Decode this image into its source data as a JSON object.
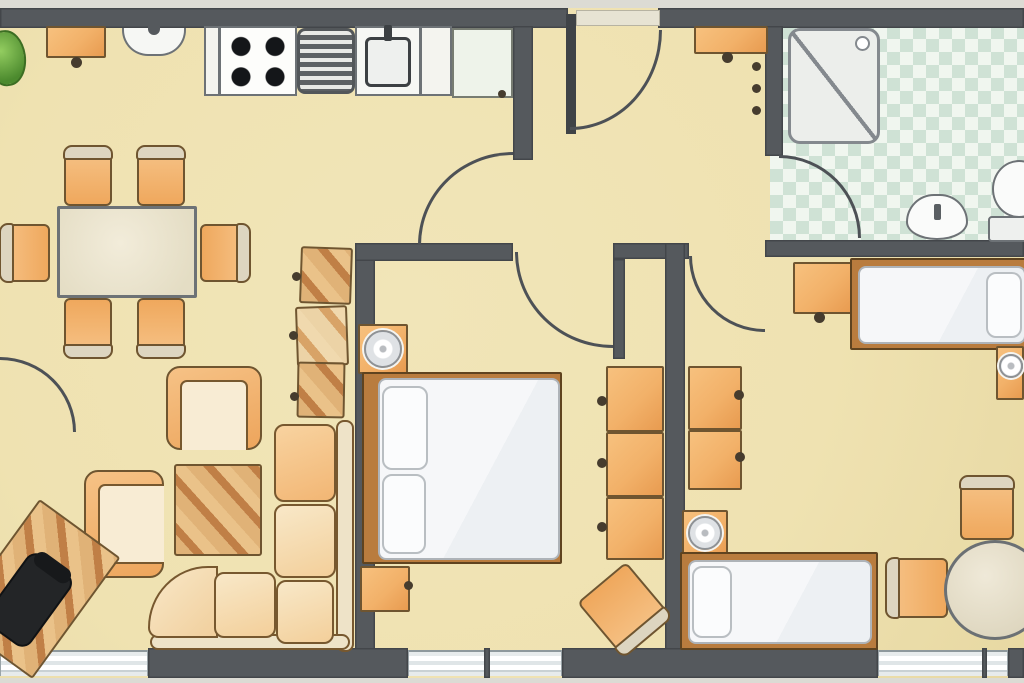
{
  "meta": {
    "type": "apartment-floor-plan",
    "canvas": {
      "w": 1024,
      "h": 683
    }
  },
  "palette": {
    "wall": "#55595d",
    "wallDark": "#3f4347",
    "arc": "#4d5156",
    "floor": "#efe2b1",
    "outside": "#dcdbd4",
    "orange": "#f2b169",
    "orangeDeep": "#e89b50",
    "woodLight": "#e0b277",
    "woodDark": "#c07f46",
    "outline": "#6f5530",
    "grayline": "#6d7276",
    "bathA": "#f0f6ef",
    "bathB": "#cfe2d5",
    "bedframe": "#b97c3e",
    "glass": "#e3eaec"
  },
  "scene": {
    "items": [
      {
        "name": "floor-area",
        "kind": "floor",
        "x": 0,
        "y": 8,
        "w": 1024,
        "h": 670
      },
      {
        "name": "outside-strip-top",
        "kind": "outside",
        "x": 0,
        "y": 0,
        "w": 1024,
        "h": 8
      },
      {
        "name": "outside-strip-bottom",
        "kind": "outside",
        "x": 0,
        "y": 678,
        "w": 1024,
        "h": 5
      },
      {
        "name": "bathroom-tile-floor",
        "kind": "bath",
        "x": 770,
        "y": 26,
        "w": 254,
        "h": 216
      },
      {
        "name": "top-wall-left",
        "kind": "wall",
        "x": 0,
        "y": 8,
        "w": 568,
        "h": 20
      },
      {
        "name": "top-wall-right",
        "kind": "wall",
        "x": 658,
        "y": 8,
        "w": 366,
        "h": 20
      },
      {
        "name": "kitchen-wall-stub",
        "kind": "wall",
        "x": 513,
        "y": 26,
        "w": 20,
        "h": 134
      },
      {
        "name": "bedroom1-left-wall",
        "kind": "wall",
        "x": 355,
        "y": 248,
        "w": 20,
        "h": 402
      },
      {
        "name": "bedroom1-top-wall",
        "kind": "wall",
        "x": 355,
        "y": 243,
        "w": 158,
        "h": 18
      },
      {
        "name": "niche-top-wall",
        "kind": "wall",
        "x": 613,
        "y": 243,
        "w": 76,
        "h": 16
      },
      {
        "name": "niche-left-wall",
        "kind": "wall",
        "x": 613,
        "y": 259,
        "w": 12,
        "h": 100
      },
      {
        "name": "room-divider-wall",
        "kind": "wall",
        "x": 665,
        "y": 243,
        "w": 20,
        "h": 407
      },
      {
        "name": "hall-bath-wall",
        "kind": "wall",
        "x": 765,
        "y": 26,
        "w": 18,
        "h": 130
      },
      {
        "name": "bath-bottom-wall",
        "kind": "wall",
        "x": 765,
        "y": 240,
        "w": 259,
        "h": 17
      },
      {
        "name": "bottom-wall-1",
        "kind": "wall",
        "x": 148,
        "y": 648,
        "w": 260,
        "h": 30
      },
      {
        "name": "bottom-wall-2",
        "kind": "wall",
        "x": 562,
        "y": 648,
        "w": 316,
        "h": 30
      },
      {
        "name": "bottom-wall-3",
        "kind": "wall",
        "x": 1008,
        "y": 648,
        "w": 16,
        "h": 30
      },
      {
        "name": "window-left",
        "kind": "window",
        "x": 0,
        "y": 650,
        "w": 148,
        "h": 26
      },
      {
        "name": "window-middle",
        "kind": "window",
        "x": 408,
        "y": 650,
        "w": 154,
        "h": 26
      },
      {
        "name": "window-right",
        "kind": "window",
        "x": 878,
        "y": 650,
        "w": 130,
        "h": 26
      },
      {
        "name": "window-mullion-mid",
        "kind": "wall",
        "x": 484,
        "y": 648,
        "w": 6,
        "h": 30
      },
      {
        "name": "window-mullion-right",
        "kind": "wall",
        "x": 982,
        "y": 648,
        "w": 5,
        "h": 30
      },
      {
        "name": "entrance-threshold",
        "kind": "threshold",
        "x": 576,
        "y": 10,
        "w": 84,
        "h": 16
      },
      {
        "name": "entrance-door-leaf",
        "kind": "wallDark",
        "x": 566,
        "y": 14,
        "w": 10,
        "h": 120
      },
      {
        "name": "entrance-door-arc",
        "kind": "arc",
        "corner": "br",
        "x": 570,
        "y": 30,
        "w": 92,
        "h": 100
      },
      {
        "name": "kitchen-passage-arc",
        "kind": "arc",
        "corner": "tl",
        "x": 418,
        "y": 152,
        "w": 95,
        "h": 93
      },
      {
        "name": "bedroom1-door-arc",
        "kind": "arc",
        "corner": "bl",
        "x": 515,
        "y": 252,
        "w": 98,
        "h": 96
      },
      {
        "name": "bedroom2-door-arc",
        "kind": "arc",
        "corner": "bl",
        "x": 689,
        "y": 256,
        "w": 76,
        "h": 76
      },
      {
        "name": "bathroom-door-arc",
        "kind": "arc",
        "corner": "tr",
        "x": 779,
        "y": 155,
        "w": 82,
        "h": 83
      },
      {
        "name": "balcony-door-arc",
        "kind": "arc",
        "corner": "tr",
        "x": 0,
        "y": 357,
        "w": 76,
        "h": 75
      },
      {
        "name": "potted-plant",
        "kind": "plant",
        "x": -12,
        "y": 30,
        "w": 38,
        "h": 56,
        "rot": -8
      },
      {
        "name": "kitchen-wall-shelf",
        "kind": "cab",
        "x": 46,
        "y": 26,
        "w": 60,
        "h": 32
      },
      {
        "name": "kitchen-shelf-knob",
        "kind": "knob",
        "x": 71,
        "y": 57,
        "w": 11,
        "h": 11
      },
      {
        "name": "kitchen-wall-fixture",
        "kind": "fixture",
        "x": 122,
        "y": 28,
        "w": 64,
        "h": 28
      },
      {
        "name": "kitchen-counter-1",
        "kind": "counter",
        "x": 204,
        "y": 26,
        "w": 16,
        "h": 70
      },
      {
        "name": "stove",
        "kind": "stove",
        "x": 219,
        "y": 26,
        "w": 78,
        "h": 70
      },
      {
        "name": "drainboard",
        "kind": "drain",
        "x": 297,
        "y": 28,
        "w": 58,
        "h": 66
      },
      {
        "name": "kitchen-sink",
        "kind": "sink",
        "x": 355,
        "y": 26,
        "w": 66,
        "h": 70
      },
      {
        "name": "kitchen-counter-2",
        "kind": "counter",
        "x": 420,
        "y": 26,
        "w": 32,
        "h": 70
      },
      {
        "name": "fridge",
        "kind": "fridge",
        "x": 452,
        "y": 28,
        "w": 61,
        "h": 70
      },
      {
        "name": "fridge-knob",
        "kind": "knob",
        "x": 498,
        "y": 90,
        "w": 8,
        "h": 8
      },
      {
        "name": "dining-chair-1",
        "kind": "chair",
        "x": 64,
        "y": 148,
        "w": 48,
        "h": 58
      },
      {
        "name": "dining-chair-2",
        "kind": "chair",
        "x": 137,
        "y": 148,
        "w": 48,
        "h": 58
      },
      {
        "name": "dining-chair-3",
        "kind": "chair",
        "x": -3,
        "y": 229,
        "w": 58,
        "h": 48,
        "rot": -90
      },
      {
        "name": "dining-chair-4",
        "kind": "chair",
        "x": 195,
        "y": 229,
        "w": 58,
        "h": 48,
        "rot": 90
      },
      {
        "name": "dining-chair-5",
        "kind": "chair",
        "x": 64,
        "y": 298,
        "w": 48,
        "h": 58,
        "rot": 180
      },
      {
        "name": "dining-chair-6",
        "kind": "chair",
        "x": 137,
        "y": 298,
        "w": 48,
        "h": 58,
        "rot": 180
      },
      {
        "name": "dining-table",
        "kind": "table",
        "x": 57,
        "y": 206,
        "w": 140,
        "h": 92
      },
      {
        "name": "shelf-unit-1",
        "kind": "wood",
        "x": 300,
        "y": 247,
        "w": 52,
        "h": 57,
        "rot": 2
      },
      {
        "name": "shelf-unit-2",
        "kind": "woodlight",
        "x": 296,
        "y": 306,
        "w": 52,
        "h": 60,
        "rot": -2
      },
      {
        "name": "shelf-unit-3",
        "kind": "wood",
        "x": 297,
        "y": 362,
        "w": 48,
        "h": 56,
        "rot": 1
      },
      {
        "name": "shelf-knob-1",
        "kind": "knob",
        "x": 292,
        "y": 272,
        "w": 9,
        "h": 9
      },
      {
        "name": "shelf-knob-2",
        "kind": "knob",
        "x": 289,
        "y": 331,
        "w": 9,
        "h": 9
      },
      {
        "name": "shelf-knob-3",
        "kind": "knob",
        "x": 290,
        "y": 392,
        "w": 9,
        "h": 9
      },
      {
        "name": "sofa-back-vertical",
        "kind": "sofaback",
        "x": 336,
        "y": 420,
        "w": 18,
        "h": 232
      },
      {
        "name": "sofa-back-horizontal",
        "kind": "sofaback",
        "x": 150,
        "y": 634,
        "w": 200,
        "h": 16
      },
      {
        "name": "sofa-corner-seat",
        "kind": "cornersofa",
        "x": 148,
        "y": 566,
        "w": 70,
        "h": 72
      },
      {
        "name": "sofa-cushion-1",
        "kind": "cushion",
        "x": 274,
        "y": 424,
        "w": 62,
        "h": 78
      },
      {
        "name": "sofa-cushion-2",
        "kind": "cushion2",
        "x": 274,
        "y": 504,
        "w": 62,
        "h": 74
      },
      {
        "name": "sofa-cushion-3",
        "kind": "cushion2",
        "x": 276,
        "y": 580,
        "w": 58,
        "h": 64
      },
      {
        "name": "sofa-cushion-4",
        "kind": "cushion2",
        "x": 214,
        "y": 572,
        "w": 62,
        "h": 66
      },
      {
        "name": "armchair-1",
        "kind": "armchair",
        "open": "s",
        "x": 166,
        "y": 366,
        "w": 96,
        "h": 84
      },
      {
        "name": "armchair-2",
        "kind": "armchair",
        "open": "e",
        "x": 84,
        "y": 470,
        "w": 80,
        "h": 108
      },
      {
        "name": "coffee-table",
        "kind": "wood",
        "x": 174,
        "y": 464,
        "w": 88,
        "h": 92
      },
      {
        "name": "desk",
        "kind": "wood",
        "x": -14,
        "y": 514,
        "w": 100,
        "h": 150,
        "rot": 36
      },
      {
        "name": "office-chair",
        "kind": "chairblack",
        "x": 2,
        "y": 556,
        "w": 54,
        "h": 88,
        "rot": 36
      },
      {
        "name": "nightstand-1",
        "kind": "cab",
        "x": 358,
        "y": 324,
        "w": 50,
        "h": 50
      },
      {
        "name": "lamp-1",
        "kind": "lamp",
        "x": 364,
        "y": 330,
        "w": 38,
        "h": 38
      },
      {
        "name": "double-bed-frame",
        "kind": "bedframe",
        "x": 362,
        "y": 372,
        "w": 200,
        "h": 192
      },
      {
        "name": "double-bed-mattress",
        "kind": "mattress",
        "x": 378,
        "y": 378,
        "w": 182,
        "h": 182
      },
      {
        "name": "pillow-1",
        "kind": "pillow",
        "x": 382,
        "y": 386,
        "w": 46,
        "h": 84
      },
      {
        "name": "pillow-2",
        "kind": "pillow",
        "x": 382,
        "y": 474,
        "w": 44,
        "h": 80
      },
      {
        "name": "nightstand-2",
        "kind": "cab",
        "x": 360,
        "y": 566,
        "w": 50,
        "h": 46
      },
      {
        "name": "nightstand-2-knob",
        "kind": "knob",
        "x": 404,
        "y": 581,
        "w": 9,
        "h": 9
      },
      {
        "name": "wardrobe-1a",
        "kind": "cab",
        "x": 606,
        "y": 366,
        "w": 58,
        "h": 66
      },
      {
        "name": "wardrobe-1b",
        "kind": "cab",
        "x": 606,
        "y": 432,
        "w": 58,
        "h": 65
      },
      {
        "name": "wardrobe-1c",
        "kind": "cab",
        "x": 606,
        "y": 497,
        "w": 58,
        "h": 63
      },
      {
        "name": "wardrobe-1-knob-a",
        "kind": "knob",
        "x": 597,
        "y": 396,
        "w": 10,
        "h": 10
      },
      {
        "name": "wardrobe-1-knob-b",
        "kind": "knob",
        "x": 597,
        "y": 458,
        "w": 10,
        "h": 10
      },
      {
        "name": "wardrobe-1-knob-c",
        "kind": "knob",
        "x": 597,
        "y": 522,
        "w": 10,
        "h": 10
      },
      {
        "name": "bedroom1-chair",
        "kind": "chair",
        "x": 592,
        "y": 574,
        "w": 64,
        "h": 70,
        "rot": 140
      },
      {
        "name": "wardrobe-2a",
        "kind": "cab",
        "x": 688,
        "y": 366,
        "w": 54,
        "h": 64
      },
      {
        "name": "wardrobe-2b",
        "kind": "cab",
        "x": 688,
        "y": 430,
        "w": 54,
        "h": 60
      },
      {
        "name": "wardrobe-2-knob-a",
        "kind": "knob",
        "x": 734,
        "y": 390,
        "w": 10,
        "h": 10
      },
      {
        "name": "wardrobe-2-knob-b",
        "kind": "knob",
        "x": 735,
        "y": 452,
        "w": 10,
        "h": 10
      },
      {
        "name": "bedroom2-desk",
        "kind": "cab",
        "x": 793,
        "y": 262,
        "w": 60,
        "h": 52
      },
      {
        "name": "bedroom2-desk-knob",
        "kind": "knob",
        "x": 814,
        "y": 312,
        "w": 11,
        "h": 11
      },
      {
        "name": "single-bed-1-frame",
        "kind": "bedframe",
        "x": 850,
        "y": 258,
        "w": 176,
        "h": 92
      },
      {
        "name": "single-bed-1-mattress",
        "kind": "mattress",
        "x": 858,
        "y": 266,
        "w": 168,
        "h": 78
      },
      {
        "name": "single-bed-1-pillow",
        "kind": "pillow",
        "x": 986,
        "y": 272,
        "w": 36,
        "h": 66
      },
      {
        "name": "nightstand-3",
        "kind": "cab",
        "x": 996,
        "y": 346,
        "w": 28,
        "h": 54
      },
      {
        "name": "lamp-2",
        "kind": "lamp",
        "x": 999,
        "y": 354,
        "w": 24,
        "h": 24
      },
      {
        "name": "nightstand-4",
        "kind": "cab",
        "x": 682,
        "y": 510,
        "w": 46,
        "h": 50
      },
      {
        "name": "lamp-3",
        "kind": "lamp",
        "x": 688,
        "y": 516,
        "w": 34,
        "h": 34
      },
      {
        "name": "single-bed-2-frame",
        "kind": "bedframe",
        "x": 680,
        "y": 552,
        "w": 198,
        "h": 98
      },
      {
        "name": "single-bed-2-mattress",
        "kind": "mattress",
        "x": 688,
        "y": 560,
        "w": 184,
        "h": 84
      },
      {
        "name": "single-bed-2-pillow",
        "kind": "pillow",
        "x": 692,
        "y": 566,
        "w": 40,
        "h": 72
      },
      {
        "name": "bedroom2-chair-1",
        "kind": "chair",
        "x": 888,
        "y": 558,
        "w": 60,
        "h": 60,
        "rot": -90
      },
      {
        "name": "bedroom2-chair-2",
        "kind": "chair",
        "x": 960,
        "y": 478,
        "w": 54,
        "h": 62
      },
      {
        "name": "round-table",
        "kind": "tableround",
        "x": 944,
        "y": 540,
        "w": 102,
        "h": 100
      },
      {
        "name": "shower-stall",
        "kind": "shower",
        "x": 788,
        "y": 28,
        "w": 92,
        "h": 116
      },
      {
        "name": "washbasin",
        "kind": "basin",
        "x": 906,
        "y": 194,
        "w": 62,
        "h": 46
      },
      {
        "name": "toilet-bowl",
        "kind": "toiletbowl",
        "x": 992,
        "y": 160,
        "w": 54,
        "h": 58
      },
      {
        "name": "toilet-tank",
        "kind": "toilettank",
        "x": 988,
        "y": 216,
        "w": 50,
        "h": 26
      },
      {
        "name": "coat-shelf",
        "kind": "cab",
        "x": 694,
        "y": 26,
        "w": 74,
        "h": 28
      },
      {
        "name": "coat-shelf-knob",
        "kind": "knob",
        "x": 722,
        "y": 52,
        "w": 11,
        "h": 11
      },
      {
        "name": "coat-hook-1",
        "kind": "knob",
        "x": 752,
        "y": 62,
        "w": 9,
        "h": 9
      },
      {
        "name": "coat-hook-2",
        "kind": "knob",
        "x": 752,
        "y": 84,
        "w": 9,
        "h": 9
      },
      {
        "name": "coat-hook-3",
        "kind": "knob",
        "x": 752,
        "y": 106,
        "w": 9,
        "h": 9
      }
    ]
  }
}
